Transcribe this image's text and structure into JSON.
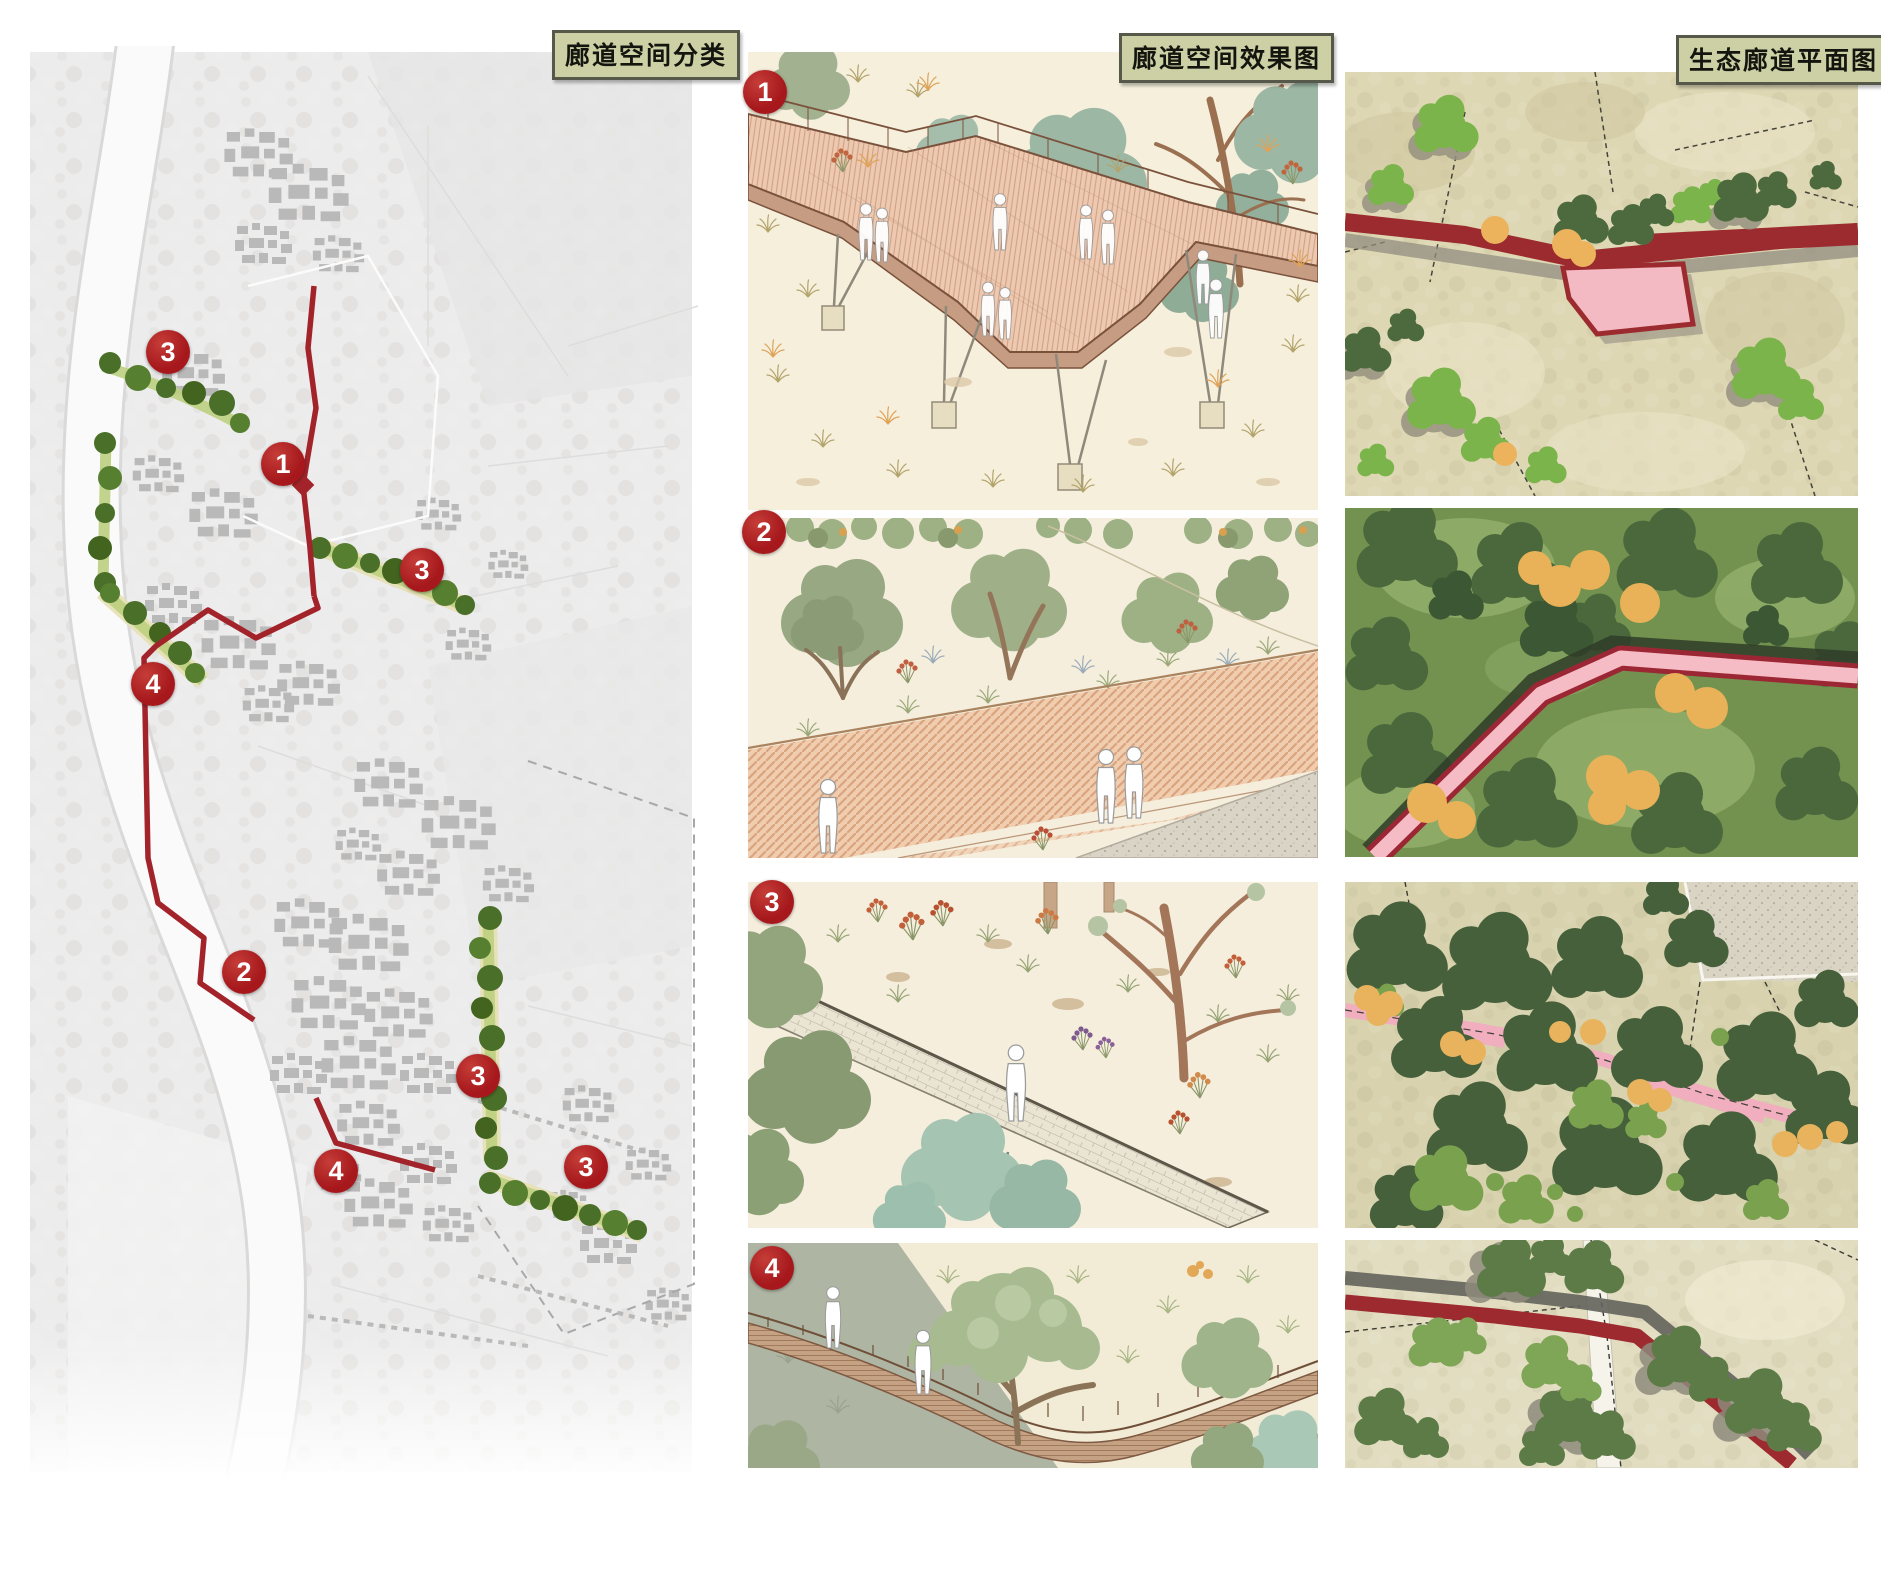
{
  "sections": {
    "classification": {
      "title": "廊道空间分类"
    },
    "renderings": {
      "title": "廊道空间效果图"
    },
    "plan": {
      "title": "生态廊道平面图"
    }
  },
  "site_plan_markers": [
    {
      "label": "3"
    },
    {
      "label": "1"
    },
    {
      "label": "3"
    },
    {
      "label": "4"
    },
    {
      "label": "2"
    },
    {
      "label": "3"
    },
    {
      "label": "4"
    },
    {
      "label": "3"
    }
  ],
  "rendering_badges": [
    {
      "label": "1"
    },
    {
      "label": "2"
    },
    {
      "label": "3"
    },
    {
      "label": "4"
    }
  ],
  "colors": {
    "badge_red": "#a6181c",
    "corridor_red": "#a2242a",
    "plan_corridor_red": "#9c2b30",
    "plan_pink": "#f4b9c4",
    "tree_dark_green": "#47633b",
    "tree_light_green": "#7cb34e",
    "accent_orange": "#e9b25c",
    "title_bg": "#ccd0a4",
    "title_border": "#565949",
    "cream": "#f5efdc",
    "sage": "#aeb5a3",
    "map_gray": "#ececec"
  }
}
